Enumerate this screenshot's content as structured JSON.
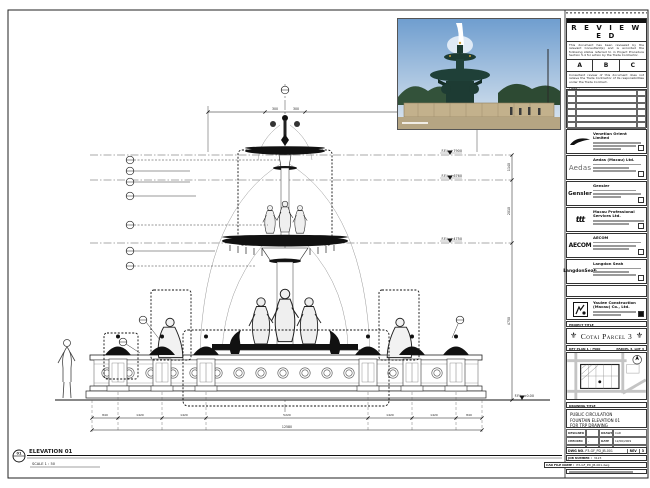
{
  "stamp": {
    "title": "R E V I E W E D",
    "para1": "This document has been reviewed by the relevant Consultant(s) and is accorded the following status referred to in Project Procedure Section 5.4 for action by the Trade Contractor.",
    "grades": [
      "A",
      "B",
      "C"
    ],
    "para2": "Consultant review of this document does not relieve the Trade Contractor of its responsibilities under the Trade Contract.",
    "date_label": "Date :"
  },
  "rev_table": {
    "headers": [
      "REV",
      "DATE / DESCRIPTION",
      "INIT"
    ]
  },
  "consultants": [
    {
      "name": "Venetian Orient Limited"
    },
    {
      "logo_text": "Aedas",
      "name": "Aedas (Macau) Ltd."
    },
    {
      "logo_text": "Gensler",
      "name": "Gensler"
    },
    {
      "logo_text": "ttt",
      "name": "Macau Professional Services Ltd."
    },
    {
      "logo_text": "AECOM",
      "name": "AECOM"
    },
    {
      "logo_text": "LangdonSeah",
      "name": "Langdon Seah"
    }
  ],
  "contractor": {
    "name": "Yaulee Construction (Macau) Co., Ltd."
  },
  "project": {
    "band_label": "PROJECT TITLE",
    "title": "Cotai Parcel 3"
  },
  "keyplan": {
    "label": "KEY PLAN",
    "scale": "1 : 7500",
    "parcel": "PARCEL 3, LOT 3"
  },
  "titleblock": {
    "band_label": "DRAWING TITLE",
    "line1": "PUBLIC CIRCULATION",
    "line2": "FOUNTAIN ELEVATION 01",
    "line3": "FOR TRP DRAWING",
    "designed_label": "DESIGNED",
    "designed": "",
    "drawn_label": "DRAWN",
    "drawn": "CAD",
    "checked_label": "CHECKED",
    "checked": "-",
    "date_label": "DATE",
    "date": "12/06/2009",
    "approved_label": "APPROVED",
    "approved": "-",
    "scale_label": "SCALE",
    "scale": "AS SHOWN",
    "dwg_label": "DWG NO.",
    "dwg_no": "P3-GF_PD_JB-001",
    "rev_label": "REV",
    "rev": "3",
    "job_label": "JOB NUMBER :",
    "job": "3123",
    "file_label": "CAD FILE NAME :",
    "file": "P3-GF_PD_JB-001.dwg"
  },
  "drawing": {
    "title": "ELEVATION 01",
    "scale_note": "SCALE 1 : 50",
    "marker": "01",
    "levels": [
      "F.F.L. +7900",
      "F.F.L. +6760",
      "F.F.L. +4750",
      "F.F.L. ±0.00"
    ],
    "vdims": [
      "1140",
      "2010",
      "4750"
    ],
    "top_dims": [
      "300",
      "300"
    ],
    "bottom_dims": [
      "840",
      "1420",
      "1420",
      "5220",
      "1420",
      "1420",
      "840"
    ],
    "overall_dim": "12580"
  }
}
